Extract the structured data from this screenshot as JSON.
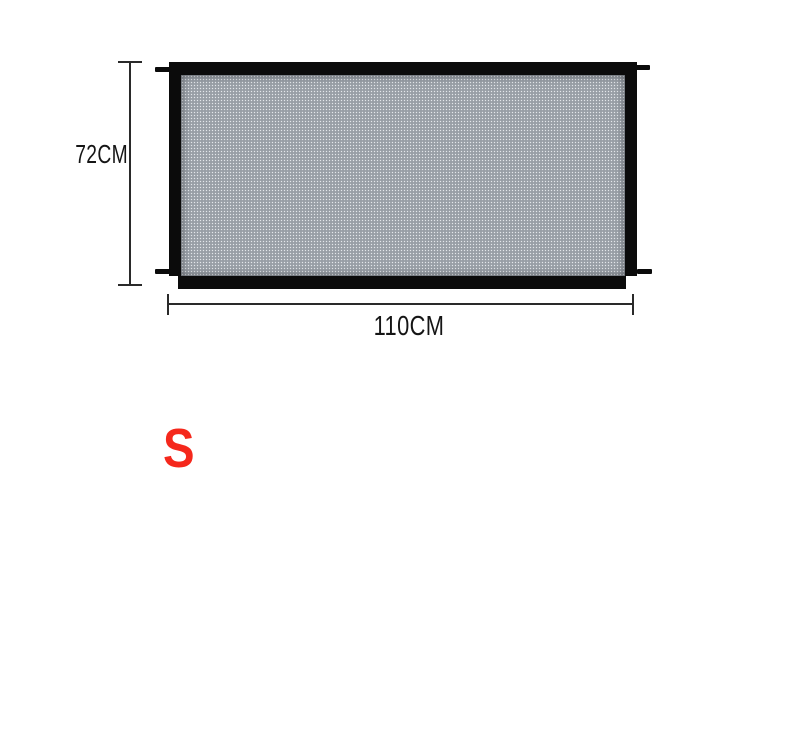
{
  "product": {
    "description": "mesh safety gate front view diagram",
    "colors": {
      "frame": "#0b0b0b",
      "mesh_base": "#858b93",
      "mesh_dot_light": "#e3e7eb",
      "mesh_dot_dark": "#a9afb6",
      "background": "#ffffff"
    }
  },
  "dimensions": {
    "line_color": "#2a2a2a",
    "height": {
      "label": "72CM"
    },
    "width": {
      "label": "110CM"
    }
  },
  "size_badge": {
    "text": "S",
    "color": "#f5281c"
  }
}
